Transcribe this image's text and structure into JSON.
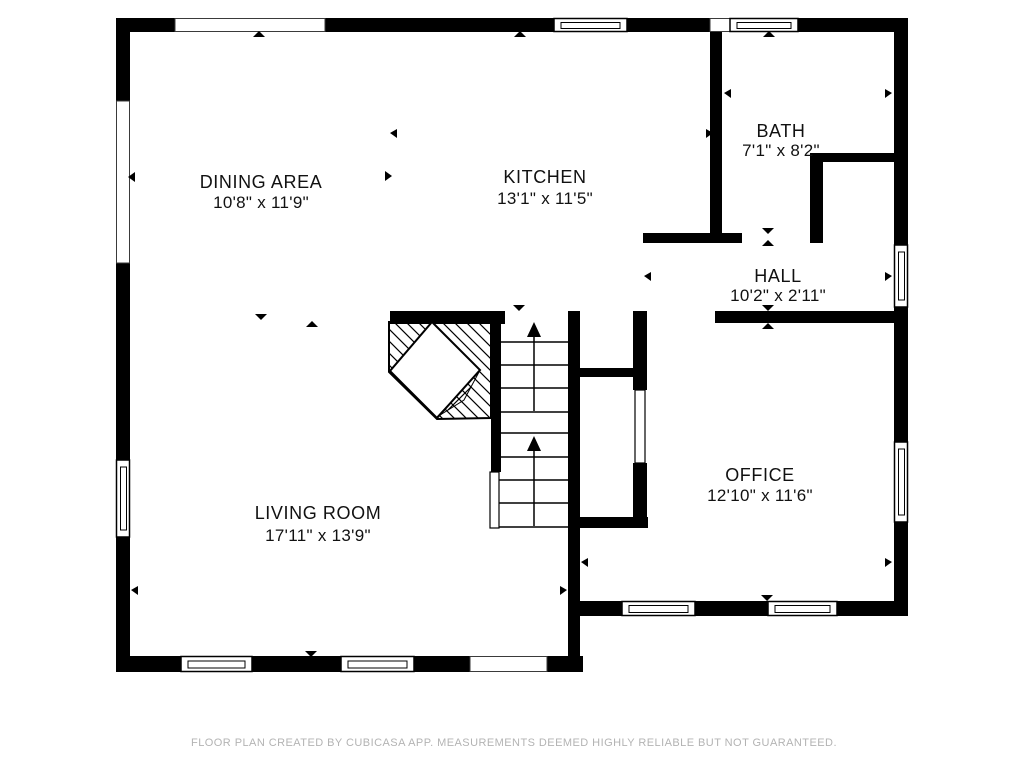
{
  "rooms": [
    {
      "key": "dining-area",
      "name": "DINING AREA",
      "dimensions": "10'8\" x 11'9\""
    },
    {
      "key": "kitchen",
      "name": "KITCHEN",
      "dimensions": "13'1\" x 11'5\""
    },
    {
      "key": "bath",
      "name": "BATH",
      "dimensions": "7'1\" x 8'2\""
    },
    {
      "key": "hall",
      "name": "HALL",
      "dimensions": "10'2\" x 2'11\""
    },
    {
      "key": "living-room",
      "name": "LIVING ROOM",
      "dimensions": "17'11\" x 13'9\""
    },
    {
      "key": "office",
      "name": "OFFICE",
      "dimensions": "12'10\" x 11'6\""
    }
  ],
  "footer": {
    "text": "FLOOR PLAN CREATED BY CUBICASA APP. MEASUREMENTS DEEMED HIGHLY RELIABLE BUT NOT GUARANTEED."
  },
  "colors": {
    "wall": "#000000",
    "background": "#ffffff",
    "footer_text": "#b3b3b3"
  },
  "icons": {
    "stairs_up_arrow": "↑",
    "opening_marker_up": "▲",
    "opening_marker_down": "▼",
    "extent_marker_left": "◄",
    "extent_marker_right": "►"
  }
}
